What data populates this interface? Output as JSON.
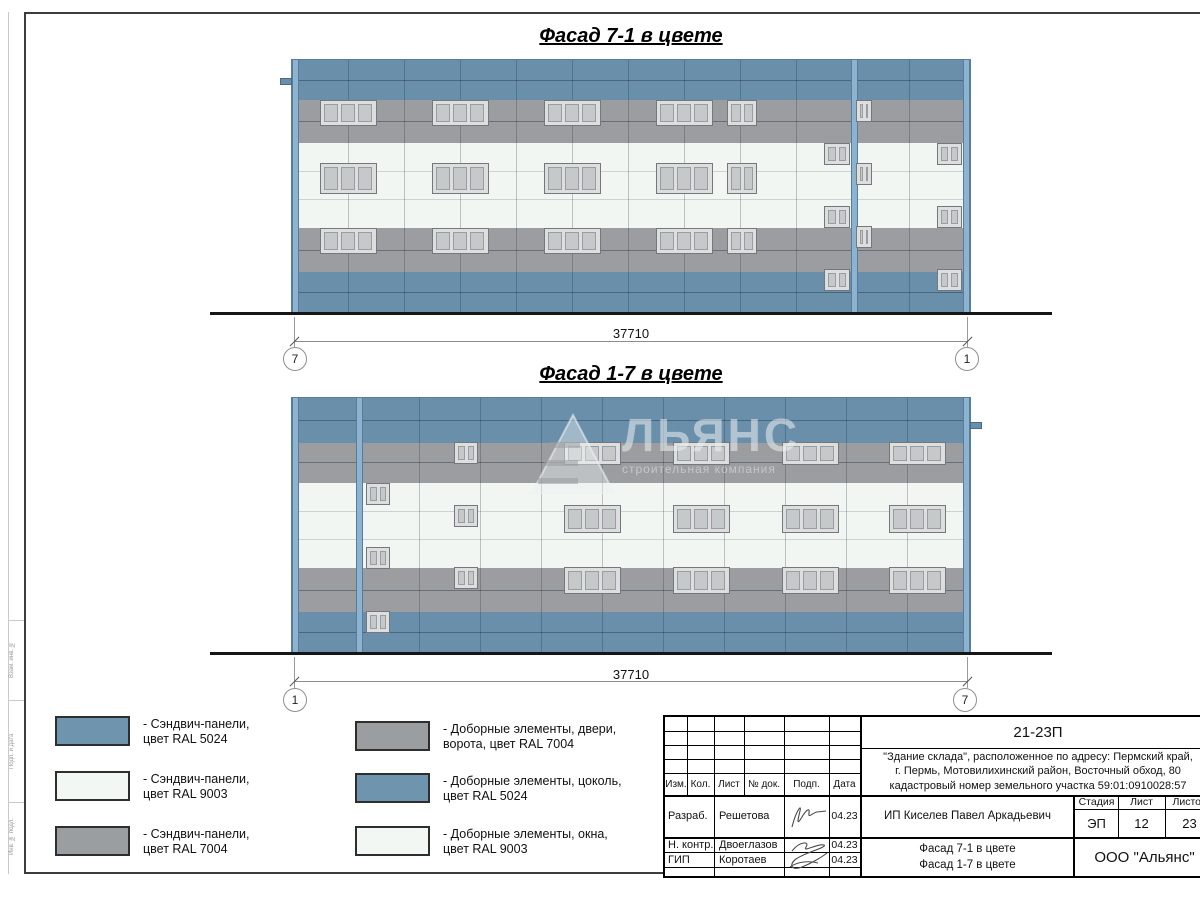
{
  "colors": {
    "ral5024": "#6f94ae",
    "ral9003": "#f3f7f4",
    "ral7004": "#9b9ea0"
  },
  "facades": [
    {
      "title": "Фасад 7-1 в цвете",
      "axis_left": "7",
      "axis_right": "1",
      "dimension": "37710",
      "x": 292,
      "y": 60,
      "w": 678,
      "h": 252,
      "bands": [
        {
          "color": "blue",
          "h": 40
        },
        {
          "color": "gray",
          "h": 43
        },
        {
          "color": "white",
          "h": 85
        },
        {
          "color": "gray",
          "h": 44
        },
        {
          "color": "blue",
          "h": 40
        }
      ],
      "hlines_dark": [
        20,
        61,
        190,
        232
      ],
      "hlines_light": [
        111,
        139
      ],
      "vjoints": [
        56,
        112,
        168,
        224,
        280,
        336,
        392,
        448,
        504,
        617
      ],
      "pilasters": [
        0,
        559,
        671
      ],
      "tab": {
        "side": "left",
        "y": 18
      },
      "windows": [
        {
          "cx": 56,
          "y": 40,
          "w": 57,
          "h": 26,
          "panes": 3
        },
        {
          "cx": 168,
          "y": 40,
          "w": 57,
          "h": 26,
          "panes": 3
        },
        {
          "cx": 280,
          "y": 40,
          "w": 57,
          "h": 26,
          "panes": 3
        },
        {
          "cx": 392,
          "y": 40,
          "w": 57,
          "h": 26,
          "panes": 3
        },
        {
          "cx": 450,
          "y": 40,
          "w": 30,
          "h": 26,
          "panes": 2
        },
        {
          "cx": 56,
          "y": 103,
          "w": 57,
          "h": 31,
          "panes": 3
        },
        {
          "cx": 168,
          "y": 103,
          "w": 57,
          "h": 31,
          "panes": 3
        },
        {
          "cx": 280,
          "y": 103,
          "w": 57,
          "h": 31,
          "panes": 3
        },
        {
          "cx": 392,
          "y": 103,
          "w": 57,
          "h": 31,
          "panes": 3
        },
        {
          "cx": 450,
          "y": 103,
          "w": 30,
          "h": 31,
          "panes": 2
        },
        {
          "cx": 56,
          "y": 168,
          "w": 57,
          "h": 26,
          "panes": 3
        },
        {
          "cx": 168,
          "y": 168,
          "w": 57,
          "h": 26,
          "panes": 3
        },
        {
          "cx": 280,
          "y": 168,
          "w": 57,
          "h": 26,
          "panes": 3
        },
        {
          "cx": 392,
          "y": 168,
          "w": 57,
          "h": 26,
          "panes": 3
        },
        {
          "cx": 450,
          "y": 168,
          "w": 30,
          "h": 26,
          "panes": 2
        },
        {
          "cx": 545,
          "y": 83,
          "w": 26,
          "h": 22,
          "panes": 2
        },
        {
          "cx": 545,
          "y": 146,
          "w": 26,
          "h": 22,
          "panes": 2
        },
        {
          "cx": 545,
          "y": 209,
          "w": 26,
          "h": 22,
          "panes": 2
        },
        {
          "cx": 572,
          "y": 40,
          "w": 16,
          "h": 22,
          "panes": 2
        },
        {
          "cx": 572,
          "y": 103,
          "w": 16,
          "h": 22,
          "panes": 2
        },
        {
          "cx": 572,
          "y": 166,
          "w": 16,
          "h": 22,
          "panes": 2
        },
        {
          "cx": 657,
          "y": 83,
          "w": 25,
          "h": 22,
          "panes": 2
        },
        {
          "cx": 657,
          "y": 146,
          "w": 25,
          "h": 22,
          "panes": 2
        },
        {
          "cx": 657,
          "y": 209,
          "w": 25,
          "h": 22,
          "panes": 2
        }
      ]
    },
    {
      "title": "Фасад 1-7 в цвете",
      "axis_left": "1",
      "axis_right": "7",
      "dimension": "37710",
      "x": 292,
      "y": 398,
      "w": 678,
      "h": 254,
      "bands": [
        {
          "color": "blue",
          "h": 45
        },
        {
          "color": "gray",
          "h": 40
        },
        {
          "color": "white",
          "h": 85
        },
        {
          "color": "gray",
          "h": 44
        },
        {
          "color": "blue",
          "h": 40
        }
      ],
      "hlines_dark": [
        22,
        64,
        192,
        234
      ],
      "hlines_light": [
        113,
        141
      ],
      "vjoints": [
        127,
        188,
        249,
        310,
        371,
        432,
        493,
        554,
        615
      ],
      "pilasters": [
        0,
        64,
        671
      ],
      "tab": {
        "side": "right",
        "y": 24
      },
      "windows": [
        {
          "cx": 300,
          "y": 44,
          "w": 57,
          "h": 23,
          "panes": 3
        },
        {
          "cx": 409,
          "y": 44,
          "w": 57,
          "h": 23,
          "panes": 3
        },
        {
          "cx": 518,
          "y": 44,
          "w": 57,
          "h": 23,
          "panes": 3
        },
        {
          "cx": 625,
          "y": 44,
          "w": 57,
          "h": 23,
          "panes": 3
        },
        {
          "cx": 300,
          "y": 107,
          "w": 57,
          "h": 28,
          "panes": 3
        },
        {
          "cx": 409,
          "y": 107,
          "w": 57,
          "h": 28,
          "panes": 3
        },
        {
          "cx": 518,
          "y": 107,
          "w": 57,
          "h": 28,
          "panes": 3
        },
        {
          "cx": 625,
          "y": 107,
          "w": 57,
          "h": 28,
          "panes": 3
        },
        {
          "cx": 300,
          "y": 169,
          "w": 57,
          "h": 27,
          "panes": 3
        },
        {
          "cx": 409,
          "y": 169,
          "w": 57,
          "h": 27,
          "panes": 3
        },
        {
          "cx": 518,
          "y": 169,
          "w": 57,
          "h": 27,
          "panes": 3
        },
        {
          "cx": 625,
          "y": 169,
          "w": 57,
          "h": 27,
          "panes": 3
        },
        {
          "cx": 86,
          "y": 85,
          "w": 24,
          "h": 22,
          "panes": 2
        },
        {
          "cx": 86,
          "y": 149,
          "w": 24,
          "h": 22,
          "panes": 2
        },
        {
          "cx": 86,
          "y": 213,
          "w": 24,
          "h": 22,
          "panes": 2
        },
        {
          "cx": 174,
          "y": 44,
          "w": 24,
          "h": 22,
          "panes": 2
        },
        {
          "cx": 174,
          "y": 107,
          "w": 24,
          "h": 22,
          "panes": 2
        },
        {
          "cx": 174,
          "y": 169,
          "w": 24,
          "h": 22,
          "panes": 2
        }
      ]
    }
  ],
  "watermark": {
    "text": "ЛЬЯНС",
    "subtext": "строительная компания"
  },
  "legend": {
    "items": [
      {
        "swatch": "ral5024",
        "line1": "- Сэндвич-панели,",
        "line2": "цвет RAL 5024"
      },
      {
        "swatch": "ral9003",
        "line1": "- Сэндвич-панели,",
        "line2": "цвет RAL 9003"
      },
      {
        "swatch": "ral7004",
        "line1": "- Сэндвич-панели,",
        "line2": "цвет RAL 7004"
      },
      {
        "swatch": "ral7004",
        "line1": "- Доборные элементы, двери,",
        "line2": "ворота, цвет RAL 7004"
      },
      {
        "swatch": "ral5024",
        "line1": "- Доборные элементы, цоколь,",
        "line2": "цвет RAL 5024"
      },
      {
        "swatch": "ral9003",
        "line1": "- Доборные элементы, окна,",
        "line2": "цвет RAL 9003"
      }
    ]
  },
  "titleblock": {
    "doc_number": "21-23П",
    "description_lines": [
      "\"Здание склада\", расположенное по адресу: Пермский край,",
      "г. Пермь, Мотовилихинский район, Восточный обход, 80",
      "кадастровый номер земельного участка 59:01:0910028:57"
    ],
    "header_cols": [
      "Изм.",
      "Кол.",
      "Лист",
      "№ док.",
      "Подп.",
      "Дата"
    ],
    "rows": [
      {
        "role": "Разраб.",
        "name": "Решетова",
        "date": "04.23"
      },
      {
        "role": "Н. контр.",
        "name": "Двоеглазов",
        "date": "04.23"
      },
      {
        "role": "ГИП",
        "name": "Коротаев",
        "date": "04.23"
      }
    ],
    "client": "ИП Киселев Павел Аркадьевич",
    "sheet_title_lines": [
      "Фасад 7-1 в цвете",
      "Фасад 1-7 в цвете"
    ],
    "stage_label": "Стадия",
    "sheet_label": "Лист",
    "sheets_label": "Листов",
    "stage": "ЭП",
    "sheet": "12",
    "sheets": "23",
    "company": "ООО \"Альянс\""
  },
  "margin_labels": [
    "Взам. инв. №",
    "Подп. и дата",
    "Инв. № подл."
  ]
}
